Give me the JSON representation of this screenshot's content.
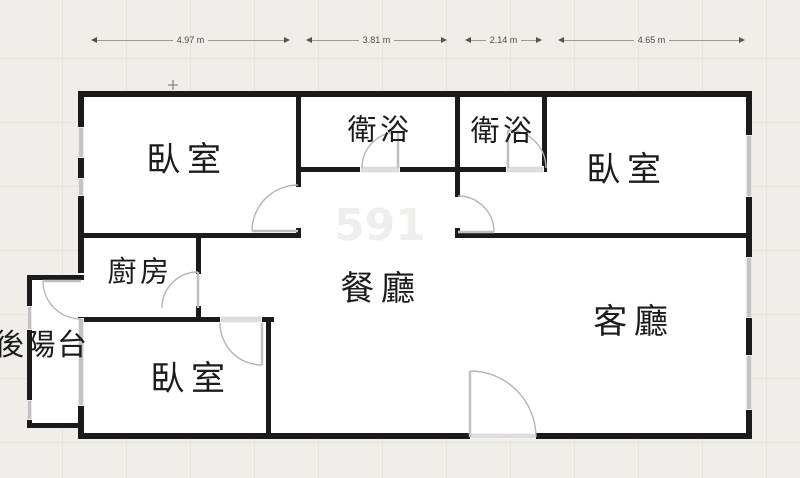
{
  "plan": {
    "type": "apartment-floor-plan",
    "units": "m"
  },
  "dims": [
    {
      "label": "4.97 m"
    },
    {
      "label": "3.81 m"
    },
    {
      "label": "2.14 m"
    },
    {
      "label": "4.65 m"
    }
  ],
  "rooms": [
    {
      "id": "bedroom-top-left",
      "label": "臥室"
    },
    {
      "id": "bathroom-1",
      "label": "衛浴"
    },
    {
      "id": "bathroom-2",
      "label": "衛浴"
    },
    {
      "id": "bedroom-right",
      "label": "臥室"
    },
    {
      "id": "kitchen",
      "label": "廚房"
    },
    {
      "id": "dining-room",
      "label": "餐廳"
    },
    {
      "id": "living-room",
      "label": "客廳"
    },
    {
      "id": "bedroom-bottom",
      "label": "臥室"
    },
    {
      "id": "rear-balcony",
      "label": "後陽台"
    }
  ],
  "watermark": "591",
  "colors": {
    "background": "#f0eeea",
    "grid": "#e7e4dd",
    "wall": "#1b1b1b",
    "floor": "#ffffff",
    "window": "#c3c3c3",
    "threshold": "#dcdcdc",
    "door_arc": "#b5b5b5",
    "dimension_text": "#4a4a46"
  }
}
